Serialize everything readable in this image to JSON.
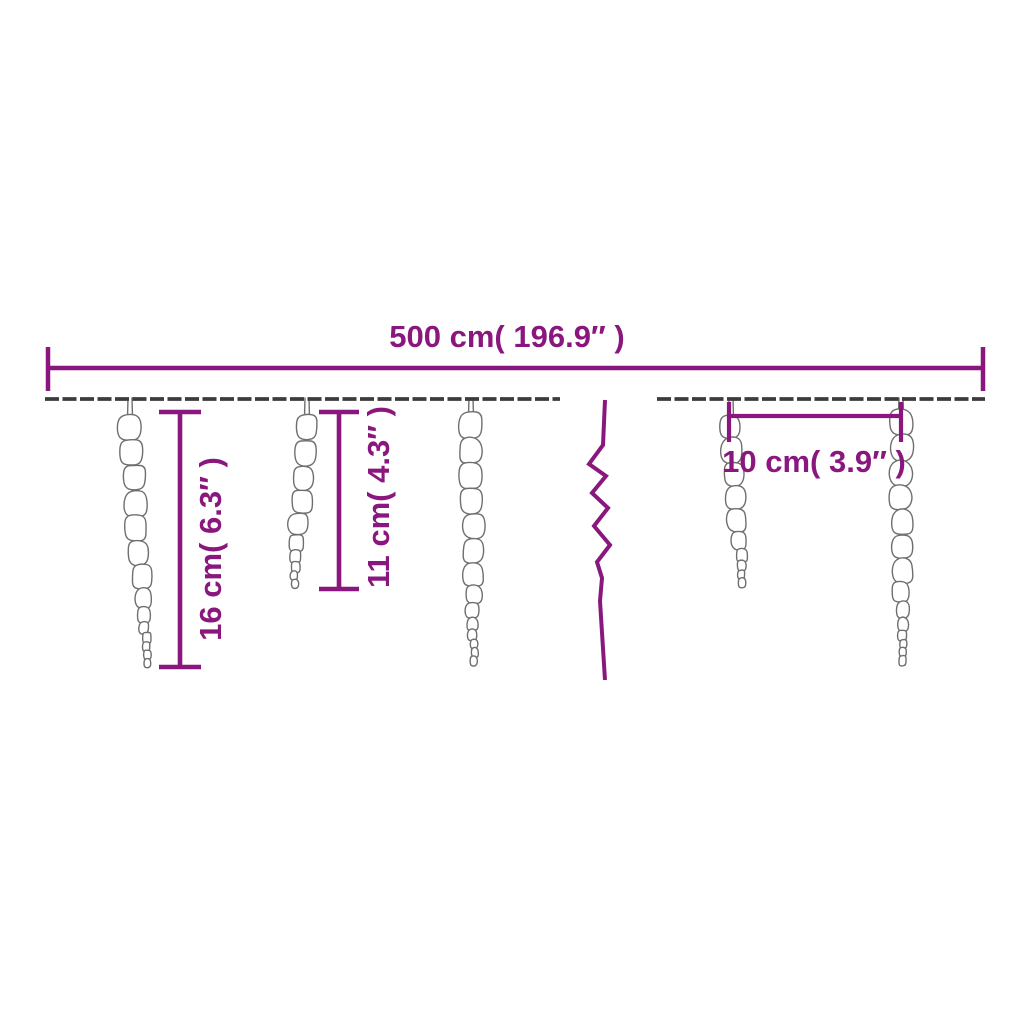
{
  "title": "Icicle string lights dimension diagram",
  "colors": {
    "background": "#ffffff",
    "dimension": "#8A177E",
    "wire": "#3c3c3c",
    "icicle_outline": "#6f6f6f",
    "icicle_fill": "#ffffff"
  },
  "labels": {
    "total_length": "500 cm( 196.9″ )",
    "long_icicle_height": "16 cm( 6.3″ )",
    "short_icicle_height": "11 cm( 4.3″ )",
    "icicle_spacing": "10 cm( 3.9″ )"
  },
  "measurements": {
    "total_length_cm": 500,
    "total_length_inch": 196.9,
    "long_icicle_cm": 16,
    "long_icicle_inch": 6.3,
    "short_icicle_cm": 11,
    "short_icicle_inch": 4.3,
    "icicle_spacing_cm": 10,
    "icicle_spacing_inch": 3.9
  },
  "diagram": {
    "wire": {
      "y": 399,
      "stroke_width": 3.8,
      "dash": "14 3.5",
      "segments": [
        [
          45,
          560
        ],
        [
          657,
          985
        ]
      ]
    },
    "total_dim": {
      "x1": 48,
      "x2": 983,
      "y": 368,
      "cap_y1": 347,
      "cap_y2": 391,
      "stroke_width": 4.5
    },
    "long_dim": {
      "x": 180,
      "y1": 412,
      "y2": 667,
      "cap": 21,
      "stroke_width": 4.6
    },
    "short_dim": {
      "x": 339,
      "y1": 412,
      "y2": 589,
      "cap": 20,
      "stroke_width": 4.6
    },
    "spacing_dim": {
      "x1": 729,
      "x2": 901,
      "y": 416,
      "cap_y1": 402,
      "cap_y2": 442,
      "stroke_width": 4.2
    },
    "break_mark": {
      "stroke_width": 4,
      "points": [
        [
          605,
          400
        ],
        [
          603,
          445
        ],
        [
          589,
          464
        ],
        [
          606,
          476
        ],
        [
          592,
          493
        ],
        [
          608,
          508
        ],
        [
          594,
          526
        ],
        [
          610,
          545
        ],
        [
          597,
          562
        ],
        [
          602,
          578
        ],
        [
          600,
          601
        ],
        [
          605,
          680
        ]
      ]
    },
    "icicles": [
      {
        "cx": 130,
        "top": 414,
        "bottom": 668,
        "width": 24,
        "drift": 18,
        "seed": 7
      },
      {
        "cx": 307,
        "top": 414,
        "bottom": 588,
        "width": 23,
        "drift": -14,
        "seed": 13
      },
      {
        "cx": 471,
        "top": 411,
        "bottom": 670,
        "width": 24,
        "drift": 3,
        "seed": 21
      },
      {
        "cx": 731,
        "top": 414,
        "bottom": 590,
        "width": 22,
        "drift": 13,
        "seed": 29
      },
      {
        "cx": 901,
        "top": 409,
        "bottom": 668,
        "width": 24,
        "drift": 1,
        "seed": 35
      }
    ],
    "label_positions": {
      "total_length": {
        "x": 507,
        "y": 337,
        "rotate": 0
      },
      "long_icicle_height": {
        "x": 211,
        "y": 549,
        "rotate": -90
      },
      "short_icicle_height": {
        "x": 379,
        "y": 497,
        "rotate": -90
      },
      "icicle_spacing": {
        "x": 814,
        "y": 462,
        "rotate": 0
      }
    }
  }
}
